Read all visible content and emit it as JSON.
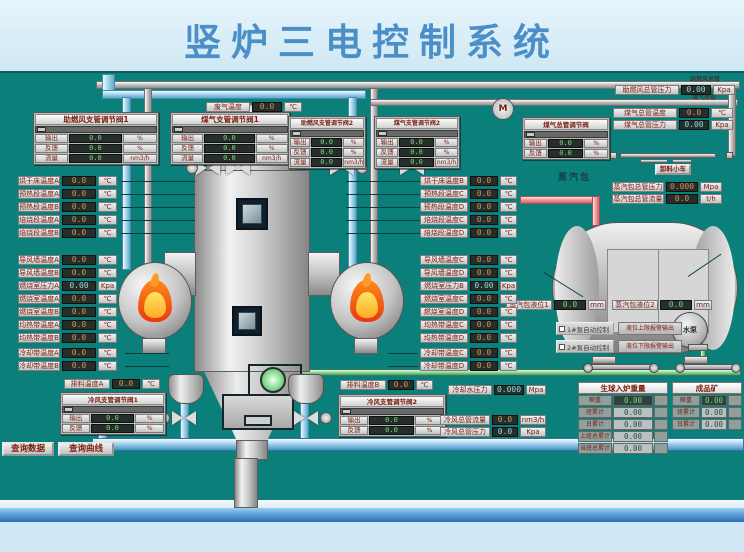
{
  "title": "竖炉三电控制系统",
  "colors": {
    "teal_bg": "#0b7f7a",
    "title_blue": "#4b8fc9",
    "value_amber": "#d69050",
    "value_green": "#79d879",
    "label_maroon": "#7a2012"
  },
  "buttons": {
    "query_data": "查询数据",
    "query_curve": "查询曲线"
  },
  "pipe_labels": {
    "air_main": "助燃风总管",
    "gas_main": "煤气总管"
  },
  "misc": {
    "exhaust": {
      "label": "废气温度",
      "value": "0.0",
      "unit": "℃"
    },
    "air_main_press": {
      "label": "助燃风总管压力",
      "value": "0.00",
      "unit": "Kpa"
    },
    "gas_main_temp": {
      "label": "煤气总管温度",
      "value": "0.0",
      "unit": "℃"
    },
    "gas_main_press": {
      "label": "煤气总管压力",
      "value": "0.00",
      "unit": "Kpa"
    },
    "blower_letter": "M"
  },
  "panels": {
    "p1": {
      "title": "助燃风支管调节阀1",
      "rows": [
        {
          "label": "输出",
          "value": "0.0",
          "unit": "%"
        },
        {
          "label": "反馈",
          "value": "0.0",
          "unit": "%"
        },
        {
          "label": "流量",
          "value": "0.0",
          "unit": "nm3/h"
        }
      ]
    },
    "p2": {
      "title": "煤气支管调节阀1",
      "rows": [
        {
          "label": "输出",
          "value": "0.0",
          "unit": "%"
        },
        {
          "label": "反馈",
          "value": "0.0",
          "unit": "%"
        },
        {
          "label": "流量",
          "value": "0.0",
          "unit": "nm3/h"
        }
      ]
    },
    "p3": {
      "title": "助燃风支管调节阀2",
      "rows": [
        {
          "label": "输出",
          "value": "0.0",
          "unit": "%"
        },
        {
          "label": "反馈",
          "value": "0.0",
          "unit": "%"
        },
        {
          "label": "流量",
          "value": "0.0",
          "unit": "nm3/h"
        }
      ]
    },
    "p4": {
      "title": "煤气支管调节阀2",
      "rows": [
        {
          "label": "输出",
          "value": "0.0",
          "unit": "%"
        },
        {
          "label": "反馈",
          "value": "0.0",
          "unit": "%"
        },
        {
          "label": "流量",
          "value": "0.0",
          "unit": "nm3/h"
        }
      ]
    },
    "p5": {
      "title": "煤气总管调节阀",
      "rows": [
        {
          "label": "输出",
          "value": "0.0",
          "unit": "%"
        },
        {
          "label": "反馈",
          "value": "0.0",
          "unit": "%"
        }
      ]
    },
    "p6": {
      "title": "冷风支管调节阀1",
      "rows": [
        {
          "label": "输出",
          "value": "0.0",
          "unit": "%"
        },
        {
          "label": "反馈",
          "value": "0.0",
          "unit": "%"
        }
      ]
    },
    "p7": {
      "title": "冷风支管调节阀2",
      "rows": [
        {
          "label": "输出",
          "value": "0.0",
          "unit": "%"
        },
        {
          "label": "反馈",
          "value": "0.0",
          "unit": "%"
        }
      ]
    }
  },
  "left_col": {
    "g1": [
      {
        "label": "烘干床温度A",
        "value": "0.0",
        "unit": "℃"
      },
      {
        "label": "预热段温度A",
        "value": "0.0",
        "unit": "℃"
      },
      {
        "label": "预热段温度B",
        "value": "0.0",
        "unit": "℃"
      },
      {
        "label": "焙烧段温度A",
        "value": "0.0",
        "unit": "℃"
      },
      {
        "label": "焙烧段温度B",
        "value": "0.0",
        "unit": "℃"
      }
    ],
    "g2": [
      {
        "label": "导风墙温度A",
        "value": "0.0",
        "unit": "℃"
      },
      {
        "label": "导风墙温度B",
        "value": "0.0",
        "unit": "℃"
      },
      {
        "label": "燃烧室压力A",
        "value": "0.00",
        "unit": "Kpa",
        "vc": "cyan"
      },
      {
        "label": "燃烧室温度A",
        "value": "0.0",
        "unit": "℃"
      },
      {
        "label": "燃烧室温度B",
        "value": "0.0",
        "unit": "℃"
      },
      {
        "label": "均热带温度A",
        "value": "0.0",
        "unit": "℃"
      },
      {
        "label": "均热带温度B",
        "value": "0.0",
        "unit": "℃"
      }
    ],
    "g3": [
      {
        "label": "冷却带温度A",
        "value": "0.0",
        "unit": "℃"
      },
      {
        "label": "冷却带温度B",
        "value": "0.0",
        "unit": "℃"
      }
    ]
  },
  "right_col": {
    "g1": [
      {
        "label": "烘干床温度B",
        "value": "0.0",
        "unit": "℃"
      },
      {
        "label": "预热段温度C",
        "value": "0.0",
        "unit": "℃"
      },
      {
        "label": "预热段温度D",
        "value": "0.0",
        "unit": "℃"
      },
      {
        "label": "焙烧段温度C",
        "value": "0.0",
        "unit": "℃"
      },
      {
        "label": "焙烧段温度D",
        "value": "0.0",
        "unit": "℃"
      }
    ],
    "g2": [
      {
        "label": "导风墙温度C",
        "value": "0.0",
        "unit": "℃"
      },
      {
        "label": "导风墙温度D",
        "value": "0.0",
        "unit": "℃"
      },
      {
        "label": "燃烧室压力B",
        "value": "0.00",
        "unit": "Kpa",
        "vc": "cyan"
      },
      {
        "label": "燃烧室温度C",
        "value": "0.0",
        "unit": "℃"
      },
      {
        "label": "燃烧室温度D",
        "value": "0.0",
        "unit": "℃"
      },
      {
        "label": "均热带温度C",
        "value": "0.0",
        "unit": "℃"
      },
      {
        "label": "均热带温度D",
        "value": "0.0",
        "unit": "℃"
      }
    ],
    "g3": [
      {
        "label": "冷却带温度C",
        "value": "0.0",
        "unit": "℃"
      },
      {
        "label": "冷却带温度D",
        "value": "0.0",
        "unit": "℃"
      }
    ]
  },
  "steam": {
    "drum_label": "蒸汽包",
    "cart_button": "卸料小车",
    "press": {
      "label": "蒸汽包总管压力",
      "value": "0.000",
      "unit": "Mpa"
    },
    "flow": {
      "label": "蒸汽包总管流量",
      "value": "0.0",
      "unit": "t/h"
    },
    "lvl1": {
      "label": "蒸汽包液位1",
      "value": "0.0",
      "unit": "mm"
    },
    "lvl2": {
      "label": "蒸汽包液位2",
      "value": "0.0",
      "unit": "mm"
    },
    "pump1": "1#泵自动控制",
    "pump2": "2#泵自动控制",
    "alarm_hi": "液位上限报警输出",
    "alarm_lo": "液位下限报警输出",
    "pump_label": "水泵"
  },
  "bottom": {
    "paiA": {
      "label": "排料温度A",
      "value": "0.0",
      "unit": "℃"
    },
    "paiB": {
      "label": "排料温度B",
      "value": "0.0",
      "unit": "℃"
    },
    "coolw": {
      "label": "冷却水压力",
      "value": "0.000",
      "unit": "Mpa"
    },
    "cw_flow": {
      "label": "冷风总管流量",
      "value": "0.0",
      "unit": "nm3/h"
    },
    "cw_press": {
      "label": "冷风总管压力",
      "value": "0.0",
      "unit": "Kpa"
    }
  },
  "tables": {
    "t1": {
      "title": "生球入炉重量",
      "rows": [
        {
          "label": "瞬重",
          "value": "0.00",
          "unit": "t/h",
          "vc": "tgreen"
        },
        {
          "label": "班累计",
          "value": "0.00",
          "unit": "t"
        },
        {
          "label": "日累计",
          "value": "0.00",
          "unit": "t"
        },
        {
          "label": "上班总累计",
          "value": "0.00",
          "unit": "t"
        },
        {
          "label": "当班总累计",
          "value": "0.00",
          "unit": "t"
        }
      ]
    },
    "t2": {
      "title": "成品矿",
      "rows": [
        {
          "label": "瞬重",
          "value": "0.00",
          "unit": "t/h",
          "vc": "tgreen"
        },
        {
          "label": "班累计",
          "value": "0.00",
          "unit": "t"
        },
        {
          "label": "日累计",
          "value": "0.00",
          "unit": "t"
        }
      ]
    }
  }
}
